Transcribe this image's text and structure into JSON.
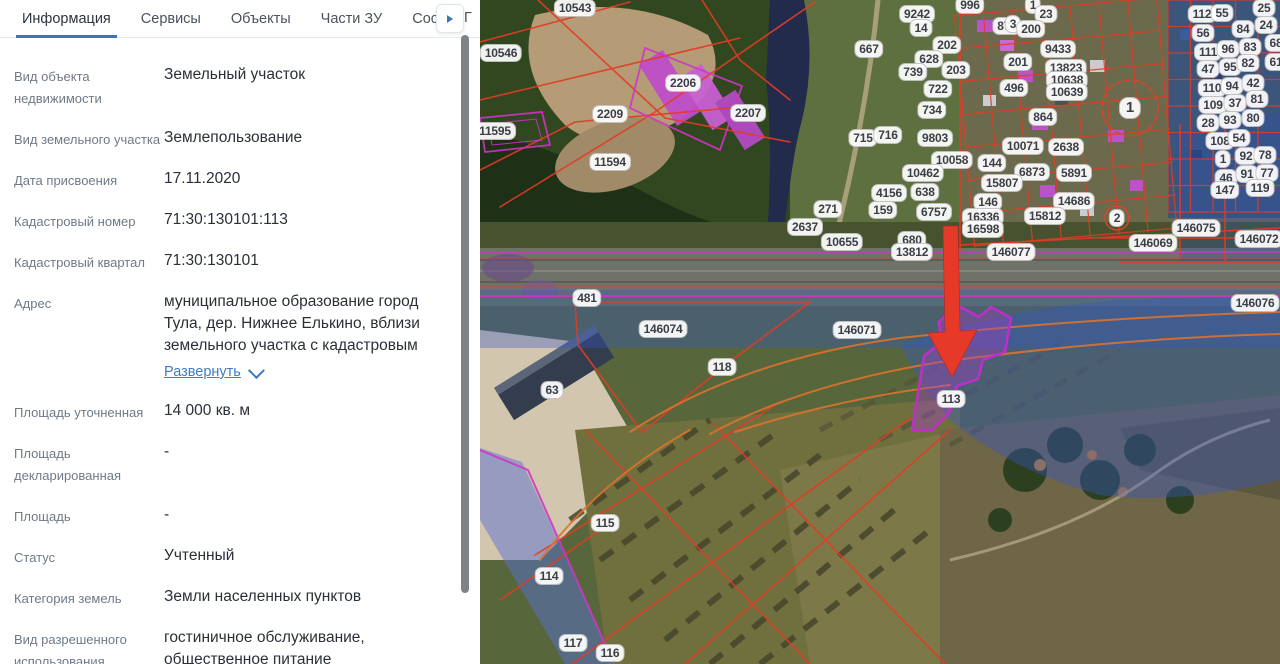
{
  "panel": {
    "accent_color": "#3a76b8",
    "tabs": [
      {
        "label": "Информация",
        "active": true
      },
      {
        "label": "Сервисы",
        "active": false
      },
      {
        "label": "Объекты",
        "active": false
      },
      {
        "label": "Части ЗУ",
        "active": false
      },
      {
        "label": "Соста",
        "active": false
      }
    ],
    "tab_scroll_icon": "arrow-right",
    "next_tab_partial": "Г",
    "fields": [
      {
        "label": "Вид объекта недвижимости",
        "value": "Земельный участок"
      },
      {
        "label": "Вид земельного участка",
        "value": "Землепользование"
      },
      {
        "label": "Дата присвоения",
        "value": "17.11.2020"
      },
      {
        "label": "Кадастровый номер",
        "value": "71:30:130101:113"
      },
      {
        "label": "Кадастровый квартал",
        "value": "71:30:130101"
      },
      {
        "label": "Адрес",
        "value": "муниципальное образование город Тула, дер. Нижнее Елькино, вблизи земельного участка с кадастровым",
        "expand_link": "Развернуть"
      },
      {
        "label": "Площадь уточненная",
        "value": "14 000 кв. м"
      },
      {
        "label": "Площадь декларированная",
        "value": "-"
      },
      {
        "label": "Площадь",
        "value": "-"
      },
      {
        "label": "Статус",
        "value": "Учтенный"
      },
      {
        "label": "Категория земель",
        "value": "Земли населенных пунктов"
      },
      {
        "label": "Вид разрешенного использования",
        "value": "гостиничное обслуживание, общественное питание"
      }
    ]
  },
  "map": {
    "highlighted_parcel": "113",
    "arrow_color": "#e73928",
    "highlight_color": "#c02ec9",
    "overlay_color": "#3557c8",
    "labels": [
      {
        "text": "10543",
        "x": 95,
        "y": 8
      },
      {
        "text": "10546",
        "x": 21,
        "y": 53
      },
      {
        "text": "2206",
        "x": 203,
        "y": 83
      },
      {
        "text": "2209",
        "x": 130,
        "y": 114
      },
      {
        "text": "11595",
        "x": 15,
        "y": 131
      },
      {
        "text": "11594",
        "x": 130,
        "y": 162
      },
      {
        "text": "2207",
        "x": 268,
        "y": 113
      },
      {
        "text": "667",
        "x": 389,
        "y": 49
      },
      {
        "text": "9242",
        "x": 437,
        "y": 14
      },
      {
        "text": "14",
        "x": 441,
        "y": 28
      },
      {
        "text": "996",
        "x": 490,
        "y": 5
      },
      {
        "text": "873",
        "x": 527,
        "y": 26
      },
      {
        "text": "202",
        "x": 467,
        "y": 45
      },
      {
        "text": "628",
        "x": 449,
        "y": 59
      },
      {
        "text": "739",
        "x": 433,
        "y": 72
      },
      {
        "text": "203",
        "x": 476,
        "y": 70
      },
      {
        "text": "722",
        "x": 458,
        "y": 89
      },
      {
        "text": "734",
        "x": 452,
        "y": 110
      },
      {
        "text": "715",
        "x": 383,
        "y": 138
      },
      {
        "text": "716",
        "x": 408,
        "y": 135
      },
      {
        "text": "9803",
        "x": 455,
        "y": 138
      },
      {
        "text": "1",
        "x": 553,
        "y": 5
      },
      {
        "text": "23",
        "x": 566,
        "y": 14
      },
      {
        "text": "3",
        "x": 533,
        "y": 24
      },
      {
        "text": "200",
        "x": 551,
        "y": 29
      },
      {
        "text": "201",
        "x": 538,
        "y": 62
      },
      {
        "text": "9433",
        "x": 578,
        "y": 49
      },
      {
        "text": "13823",
        "x": 586,
        "y": 68
      },
      {
        "text": "10638",
        "x": 587,
        "y": 80
      },
      {
        "text": "10639",
        "x": 587,
        "y": 92
      },
      {
        "text": "496",
        "x": 534,
        "y": 88
      },
      {
        "text": "864",
        "x": 563,
        "y": 117
      },
      {
        "text": "1",
        "x": 650,
        "y": 108,
        "lg": true
      },
      {
        "text": "10071",
        "x": 543,
        "y": 146
      },
      {
        "text": "2638",
        "x": 586,
        "y": 147
      },
      {
        "text": "112",
        "x": 722,
        "y": 14
      },
      {
        "text": "55",
        "x": 742,
        "y": 13
      },
      {
        "text": "25",
        "x": 784,
        "y": 8
      },
      {
        "text": "56",
        "x": 723,
        "y": 33
      },
      {
        "text": "84",
        "x": 763,
        "y": 29
      },
      {
        "text": "24",
        "x": 786,
        "y": 25
      },
      {
        "text": "111",
        "x": 728,
        "y": 52
      },
      {
        "text": "96",
        "x": 748,
        "y": 49
      },
      {
        "text": "83",
        "x": 770,
        "y": 47
      },
      {
        "text": "68",
        "x": 796,
        "y": 43
      },
      {
        "text": "47",
        "x": 728,
        "y": 69
      },
      {
        "text": "95",
        "x": 750,
        "y": 67
      },
      {
        "text": "82",
        "x": 768,
        "y": 63
      },
      {
        "text": "61",
        "x": 796,
        "y": 62
      },
      {
        "text": "110",
        "x": 732,
        "y": 88
      },
      {
        "text": "94",
        "x": 752,
        "y": 86
      },
      {
        "text": "42",
        "x": 773,
        "y": 83
      },
      {
        "text": "109",
        "x": 733,
        "y": 105
      },
      {
        "text": "37",
        "x": 755,
        "y": 103
      },
      {
        "text": "81",
        "x": 777,
        "y": 99
      },
      {
        "text": "28",
        "x": 728,
        "y": 123
      },
      {
        "text": "93",
        "x": 750,
        "y": 120
      },
      {
        "text": "80",
        "x": 773,
        "y": 118
      },
      {
        "text": "108",
        "x": 740,
        "y": 141
      },
      {
        "text": "54",
        "x": 759,
        "y": 138
      },
      {
        "text": "1",
        "x": 743,
        "y": 159
      },
      {
        "text": "92",
        "x": 766,
        "y": 156
      },
      {
        "text": "78",
        "x": 785,
        "y": 155
      },
      {
        "text": "46",
        "x": 746,
        "y": 178
      },
      {
        "text": "91",
        "x": 767,
        "y": 174
      },
      {
        "text": "77",
        "x": 787,
        "y": 173
      },
      {
        "text": "147",
        "x": 745,
        "y": 190
      },
      {
        "text": "119",
        "x": 780,
        "y": 188
      },
      {
        "text": "10058",
        "x": 472,
        "y": 160
      },
      {
        "text": "144",
        "x": 512,
        "y": 163
      },
      {
        "text": "6873",
        "x": 552,
        "y": 172
      },
      {
        "text": "5891",
        "x": 594,
        "y": 173
      },
      {
        "text": "10462",
        "x": 443,
        "y": 173
      },
      {
        "text": "15807",
        "x": 522,
        "y": 183
      },
      {
        "text": "4156",
        "x": 409,
        "y": 193
      },
      {
        "text": "638",
        "x": 445,
        "y": 192
      },
      {
        "text": "146",
        "x": 508,
        "y": 202
      },
      {
        "text": "14686",
        "x": 594,
        "y": 201
      },
      {
        "text": "159",
        "x": 403,
        "y": 210
      },
      {
        "text": "6757",
        "x": 454,
        "y": 212
      },
      {
        "text": "16336",
        "x": 503,
        "y": 217
      },
      {
        "text": "15812",
        "x": 565,
        "y": 216
      },
      {
        "text": "16598",
        "x": 503,
        "y": 229
      },
      {
        "text": "680",
        "x": 432,
        "y": 240
      },
      {
        "text": "13812",
        "x": 432,
        "y": 252
      },
      {
        "text": "146077",
        "x": 531,
        "y": 252
      },
      {
        "text": "2",
        "x": 637,
        "y": 218
      },
      {
        "text": "271",
        "x": 348,
        "y": 209
      },
      {
        "text": "2637",
        "x": 325,
        "y": 227
      },
      {
        "text": "10655",
        "x": 362,
        "y": 242
      },
      {
        "text": "146069",
        "x": 673,
        "y": 243
      },
      {
        "text": "146075",
        "x": 716,
        "y": 228
      },
      {
        "text": "146072",
        "x": 779,
        "y": 239
      },
      {
        "text": "146076",
        "x": 775,
        "y": 303
      },
      {
        "text": "481",
        "x": 107,
        "y": 298
      },
      {
        "text": "146074",
        "x": 183,
        "y": 329
      },
      {
        "text": "118",
        "x": 242,
        "y": 367
      },
      {
        "text": "146071",
        "x": 377,
        "y": 330
      },
      {
        "text": "113",
        "x": 471,
        "y": 399
      },
      {
        "text": "63",
        "x": 72,
        "y": 390
      },
      {
        "text": "115",
        "x": 125,
        "y": 523
      },
      {
        "text": "114",
        "x": 69,
        "y": 576
      },
      {
        "text": "117",
        "x": 93,
        "y": 643
      },
      {
        "text": "116",
        "x": 130,
        "y": 653
      }
    ]
  }
}
